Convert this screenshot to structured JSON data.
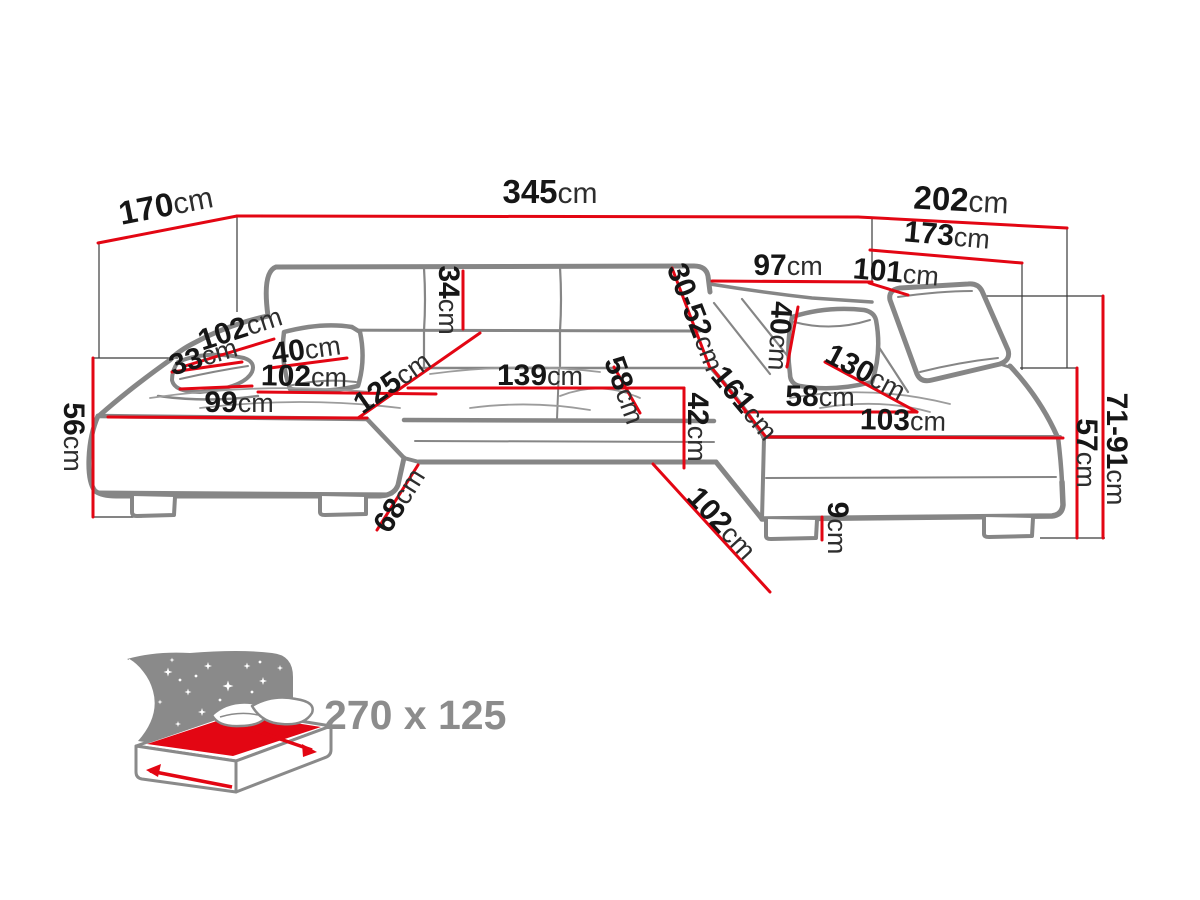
{
  "diagram": {
    "title": "corner-sofa-dimensions",
    "dims": {
      "d170": {
        "num": "170",
        "unit": "cm"
      },
      "d345": {
        "num": "345",
        "unit": "cm"
      },
      "d202": {
        "num": "202",
        "unit": "cm"
      },
      "d173": {
        "num": "173",
        "unit": "cm"
      },
      "d97": {
        "num": "97",
        "unit": "cm"
      },
      "d101": {
        "num": "101",
        "unit": "cm"
      },
      "d34": {
        "num": "34",
        "unit": "cm"
      },
      "d3052": {
        "num": "30-52",
        "unit": "cm"
      },
      "d40l": {
        "num": "40",
        "unit": "cm"
      },
      "d102arm": {
        "num": "102",
        "unit": "cm"
      },
      "d33": {
        "num": "33",
        "unit": "cm"
      },
      "d102seat": {
        "num": "102",
        "unit": "cm"
      },
      "d99": {
        "num": "99",
        "unit": "cm"
      },
      "d125": {
        "num": "125",
        "unit": "cm"
      },
      "d139": {
        "num": "139",
        "unit": "cm"
      },
      "d58mid": {
        "num": "58",
        "unit": "cm"
      },
      "d42": {
        "num": "42",
        "unit": "cm"
      },
      "d161": {
        "num": "161",
        "unit": "cm"
      },
      "d58r": {
        "num": "58",
        "unit": "cm"
      },
      "d130": {
        "num": "130",
        "unit": "cm"
      },
      "d103": {
        "num": "103",
        "unit": "cm"
      },
      "d40r": {
        "num": "40",
        "unit": "cm"
      },
      "d102inner": {
        "num": "102",
        "unit": "cm"
      },
      "d68": {
        "num": "68",
        "unit": "cm"
      },
      "d9": {
        "num": "9",
        "unit": "cm"
      },
      "d56": {
        "num": "56",
        "unit": "cm"
      },
      "d57": {
        "num": "57",
        "unit": "cm"
      },
      "d7191": {
        "num": "71-91",
        "unit": "cm"
      }
    },
    "sleeping_area": {
      "label": "270 x 125"
    },
    "colors": {
      "dimension_red": "#e30613",
      "outline_gray": "#868686",
      "icon_gray": "#8a8a8a",
      "text_black": "#161616"
    }
  }
}
